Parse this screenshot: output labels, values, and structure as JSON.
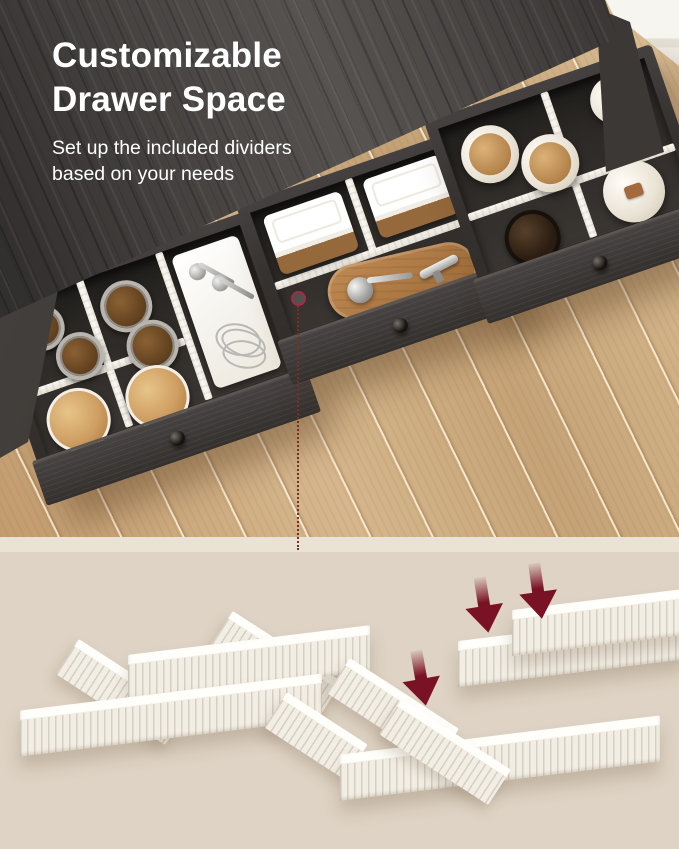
{
  "headline": {
    "title_line1": "Customizable",
    "title_line2": "Drawer Space",
    "subtitle_line1": "Set up the included dividers",
    "subtitle_line2": "based on your needs"
  },
  "colors": {
    "title": "#ffffff",
    "countertop": "#4a4644",
    "drawer_wood": "#35322f",
    "floor": "#cdab7f",
    "divider_white": "#f5f1e8",
    "beige": "#ded3c4",
    "band": "#eae2d5",
    "arrow": "#7a1226",
    "ring": "#a12d47",
    "dots": "#7a2f22",
    "wood_lid": "#cf9f63",
    "cutting_board": "#b07a45"
  },
  "scene": {
    "section_top": "photo of dark gray sideboard with three open drawers organized by white dividers, on light wood floor",
    "drawer_left_items": [
      "spice jars",
      "wood-lid jars",
      "tray with spoons",
      "whisk"
    ],
    "drawer_middle_items": [
      "two lidded food containers",
      "cutting board",
      "measuring scoop",
      "corkscrew"
    ],
    "drawer_right_items": [
      "wood-lid canisters",
      "candle jar",
      "dark glass jar",
      "ceramic canister with tag"
    ],
    "section_bottom": "illustration of white drawer dividers assembled into grids, three arrows showing insertion",
    "arrow_count": 3
  }
}
